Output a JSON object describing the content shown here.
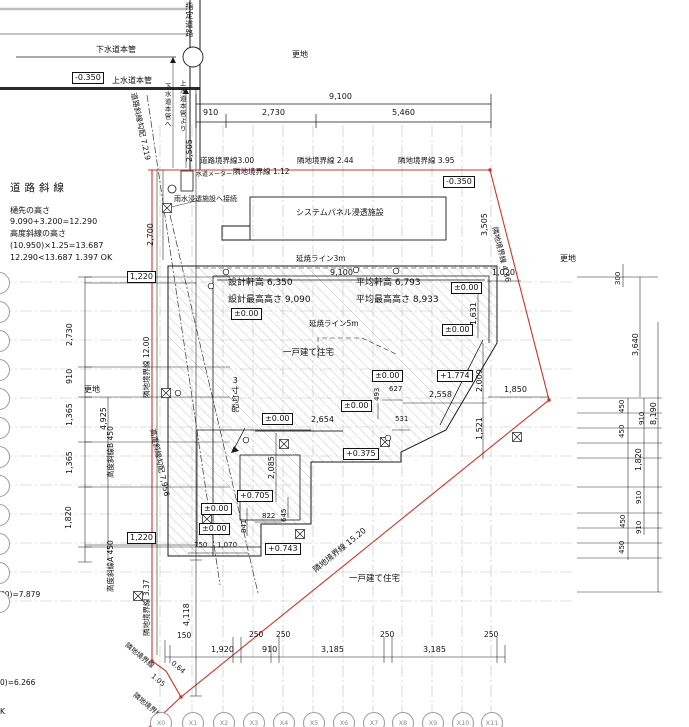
{
  "meta": {
    "bg": "#ffffff",
    "ink": "#1a1a1a",
    "red": "#c9342b",
    "grid_gray": "#c2c2c2",
    "hatch_gray": "#a0a0a0"
  },
  "notes": {
    "heading": "道路斜線",
    "line1": "樋先の高さ",
    "line2": "9.090+3.200=12.290",
    "line3": "高度斜線の高さ",
    "line4": "(10.950)×1.25=13.687",
    "line5": "12.290<13.687  1.397 OK"
  },
  "texts": [
    {
      "t": "下水道本管",
      "x": 96,
      "y": 46,
      "n": "sewer-main-label"
    },
    {
      "t": "-0.350",
      "x": 72,
      "y": 72,
      "k": "b",
      "n": "elevation-label"
    },
    {
      "t": "上水道本管",
      "x": 112,
      "y": 77,
      "n": "water-main-label"
    },
    {
      "t": "指定道路",
      "x": 184,
      "y": 2,
      "k": "j",
      "n": "designated-road-label"
    },
    {
      "t": "更地",
      "x": 292,
      "y": 51,
      "n": "area-label-vacant-lot"
    },
    {
      "t": "9,100",
      "x": 329,
      "y": 93,
      "n": "dim-label"
    },
    {
      "t": "910",
      "x": 203,
      "y": 109,
      "n": "dim-label"
    },
    {
      "t": "2,730",
      "x": 262,
      "y": 109,
      "n": "dim-label"
    },
    {
      "t": "5,460",
      "x": 392,
      "y": 109,
      "n": "dim-label"
    },
    {
      "t": "下水道本管へ",
      "x": 163,
      "y": 83,
      "k": "j",
      "s": 6.5,
      "n": "utility-label"
    },
    {
      "t": "上水道本管より",
      "x": 178,
      "y": 80,
      "k": "j",
      "s": 6.5,
      "n": "utility-label"
    },
    {
      "t": "2,505",
      "x": 186,
      "y": 162,
      "k": "v",
      "n": "dim-label"
    },
    {
      "t": "道路境界線3.00",
      "x": 200,
      "y": 157,
      "s": 7.5,
      "n": "road-boundary-label"
    },
    {
      "t": "水道メーター",
      "x": 196,
      "y": 172,
      "s": 6,
      "n": "water-meter-label"
    },
    {
      "t": "隣地境界線 1.12",
      "x": 233,
      "y": 168,
      "s": 7.5,
      "n": "boundary-label"
    },
    {
      "t": "隣地境界線 2.44",
      "x": 297,
      "y": 157,
      "s": 7.5,
      "n": "boundary-label"
    },
    {
      "t": "隣地境界線 3.95",
      "x": 398,
      "y": 157,
      "s": 7.5,
      "n": "boundary-label"
    },
    {
      "t": "-0.350",
      "x": 443,
      "y": 176,
      "k": "b",
      "n": "elevation-label"
    },
    {
      "t": "雨水浸透施設へ接続",
      "x": 174,
      "y": 196,
      "s": 7,
      "n": "rainwater-label"
    },
    {
      "t": "システムパネル浸透施設",
      "x": 296,
      "y": 209,
      "s": 8,
      "n": "infiltration-panel-label"
    },
    {
      "t": "2,700",
      "x": 147,
      "y": 246,
      "k": "v",
      "n": "dim-label"
    },
    {
      "t": "道路斜線勾配 7.219",
      "x": 137,
      "y": 92,
      "k": "r",
      "r": 78,
      "s": 7.5,
      "n": "road-slope-label"
    },
    {
      "t": "高度斜線勾配 7,956",
      "x": 156,
      "y": 428,
      "k": "r",
      "r": 78,
      "s": 7.5,
      "n": "height-slope-label"
    },
    {
      "t": "隣地境界線 4.36",
      "x": 498,
      "y": 226,
      "k": "r",
      "r": 76,
      "s": 7.5,
      "n": "boundary-label"
    },
    {
      "t": "3,505",
      "x": 481,
      "y": 236,
      "k": "v",
      "n": "dim-label"
    },
    {
      "t": "更地",
      "x": 560,
      "y": 255,
      "n": "area-label-vacant-lot"
    },
    {
      "t": "1,220",
      "x": 127,
      "y": 271,
      "k": "b",
      "n": "dim-box"
    },
    {
      "t": "2,730",
      "x": 66,
      "y": 346,
      "k": "v",
      "n": "dim-label"
    },
    {
      "t": "910",
      "x": 66,
      "y": 384,
      "k": "v",
      "n": "dim-label"
    },
    {
      "t": "更地",
      "x": 84,
      "y": 386,
      "n": "area-label-vacant-lot"
    },
    {
      "t": "1,365",
      "x": 66,
      "y": 426,
      "k": "v",
      "n": "dim-label"
    },
    {
      "t": "4,925",
      "x": 100,
      "y": 430,
      "k": "v",
      "n": "dim-label"
    },
    {
      "t": "1,365",
      "x": 66,
      "y": 474,
      "k": "v",
      "n": "dim-label"
    },
    {
      "t": "1,820",
      "x": 65,
      "y": 529,
      "k": "v",
      "n": "dim-label"
    },
    {
      "t": "高度斜線B 450",
      "x": 107,
      "y": 478,
      "k": "v",
      "s": 7.5,
      "n": "height-slope-b-label"
    },
    {
      "t": "高度斜線A 450",
      "x": 107,
      "y": 592,
      "k": "v",
      "s": 7.5,
      "n": "height-slope-a-label"
    },
    {
      "t": "隣地境界線 12.00",
      "x": 143,
      "y": 398,
      "k": "v",
      "s": 7.5,
      "n": "boundary-label"
    },
    {
      "t": "1,220",
      "x": 127,
      "y": 532,
      "k": "b",
      "n": "dim-box"
    },
    {
      "t": "延焼ライン3m",
      "x": 296,
      "y": 255,
      "s": 7.5,
      "n": "fire-spread-line-3m-label"
    },
    {
      "t": "9,100",
      "x": 330,
      "y": 269,
      "n": "dim-label"
    },
    {
      "t": "設計軒高 6,350",
      "x": 228,
      "y": 279,
      "s": 9,
      "n": "design-eave-height"
    },
    {
      "t": "平均軒高 6,793",
      "x": 356,
      "y": 279,
      "s": 9,
      "n": "average-eave-height"
    },
    {
      "t": "設計最高高さ 9,090",
      "x": 228,
      "y": 296,
      "s": 9,
      "n": "design-max-height"
    },
    {
      "t": "平均最高高さ 8,933",
      "x": 356,
      "y": 296,
      "s": 9,
      "n": "average-max-height"
    },
    {
      "t": "±0.00",
      "x": 451,
      "y": 282,
      "k": "b",
      "n": "elevation-label"
    },
    {
      "t": "1,020",
      "x": 492,
      "y": 269,
      "n": "dim-label"
    },
    {
      "t": "1,631",
      "x": 470,
      "y": 325,
      "k": "v",
      "n": "dim-label"
    },
    {
      "t": "±0.00",
      "x": 231,
      "y": 308,
      "k": "b",
      "n": "elevation-label"
    },
    {
      "t": "延焼ライン5m",
      "x": 309,
      "y": 320,
      "s": 7.5,
      "n": "fire-spread-line-5m-label"
    },
    {
      "t": "±0.00",
      "x": 442,
      "y": 324,
      "k": "b",
      "n": "elevation-label"
    },
    {
      "t": "一戸建て住宅",
      "x": 283,
      "y": 349,
      "s": 8.5,
      "n": "detached-house-label"
    },
    {
      "t": "2,009",
      "x": 476,
      "y": 392,
      "k": "v",
      "n": "dim-label"
    },
    {
      "t": "3寸勾配",
      "x": 230,
      "y": 376,
      "k": "j",
      "s": 8,
      "n": "roof-pitch-label"
    },
    {
      "t": "±0.00",
      "x": 372,
      "y": 370,
      "k": "b",
      "n": "elevation-label"
    },
    {
      "t": "+1.774",
      "x": 437,
      "y": 370,
      "k": "b",
      "n": "elevation-label"
    },
    {
      "t": "493",
      "x": 374,
      "y": 401,
      "k": "v",
      "s": 7,
      "n": "dim-label"
    },
    {
      "t": "627",
      "x": 389,
      "y": 386,
      "s": 7,
      "n": "dim-label"
    },
    {
      "t": "2,558",
      "x": 429,
      "y": 391,
      "n": "dim-label"
    },
    {
      "t": "1,850",
      "x": 504,
      "y": 386,
      "n": "dim-label"
    },
    {
      "t": "1,521",
      "x": 476,
      "y": 440,
      "k": "v",
      "n": "dim-label"
    },
    {
      "t": "±0.00",
      "x": 341,
      "y": 400,
      "k": "b",
      "n": "elevation-label"
    },
    {
      "t": "±0.00",
      "x": 262,
      "y": 413,
      "k": "b",
      "n": "elevation-label"
    },
    {
      "t": "2,654",
      "x": 311,
      "y": 416,
      "n": "dim-label"
    },
    {
      "t": "531",
      "x": 395,
      "y": 416,
      "s": 7,
      "n": "dim-label"
    },
    {
      "t": "+0.375",
      "x": 343,
      "y": 448,
      "k": "b",
      "n": "elevation-label"
    },
    {
      "t": "2,085",
      "x": 268,
      "y": 479,
      "k": "v",
      "n": "dim-label"
    },
    {
      "t": "+0.705",
      "x": 237,
      "y": 490,
      "k": "b",
      "n": "elevation-label"
    },
    {
      "t": "645",
      "x": 281,
      "y": 522,
      "k": "v",
      "s": 7,
      "n": "dim-label"
    },
    {
      "t": "841",
      "x": 241,
      "y": 533,
      "k": "v",
      "s": 7,
      "n": "dim-label"
    },
    {
      "t": "822",
      "x": 262,
      "y": 513,
      "s": 7,
      "n": "dim-label"
    },
    {
      "t": "±0.00",
      "x": 201,
      "y": 503,
      "k": "b",
      "n": "elevation-label"
    },
    {
      "t": "±0.00",
      "x": 199,
      "y": 523,
      "k": "b",
      "n": "elevation-label"
    },
    {
      "t": "750",
      "x": 194,
      "y": 542,
      "s": 7,
      "n": "dim-label"
    },
    {
      "t": "1,070",
      "x": 217,
      "y": 542,
      "s": 7,
      "n": "dim-label"
    },
    {
      "t": "+0.743",
      "x": 265,
      "y": 543,
      "k": "b",
      "n": "elevation-label"
    },
    {
      "t": "隣地境界線 15.20",
      "x": 312,
      "y": 568,
      "k": "r",
      "r": -39,
      "s": 8,
      "n": "boundary-label"
    },
    {
      "t": "一戸建て住宅",
      "x": 349,
      "y": 575,
      "s": 8.5,
      "n": "neighbor-house-label"
    },
    {
      "t": "隣地境界線 3.37",
      "x": 143,
      "y": 636,
      "k": "v",
      "s": 7.5,
      "n": "boundary-label"
    },
    {
      "t": "4,118",
      "x": 183,
      "y": 626,
      "k": "v",
      "n": "dim-label"
    },
    {
      "t": "隣地境界線",
      "x": 128,
      "y": 642,
      "k": "r",
      "r": 40,
      "s": 7,
      "n": "boundary-label"
    },
    {
      "t": "0.64",
      "x": 174,
      "y": 660,
      "k": "r",
      "r": 40,
      "s": 7,
      "n": "boundary-length-label"
    },
    {
      "t": "1.05",
      "x": 154,
      "y": 673,
      "k": "r",
      "r": 40,
      "s": 7,
      "n": "boundary-length-label"
    },
    {
      "t": "隣地境界線",
      "x": 136,
      "y": 692,
      "k": "r",
      "r": 40,
      "s": 7,
      "n": "boundary-label"
    },
    {
      "t": "80)=7.879",
      "x": 0,
      "y": 591,
      "s": 7.5,
      "n": "cut-formula-text"
    },
    {
      "t": "0)=6.266",
      "x": 0,
      "y": 679,
      "s": 7.5,
      "n": "cut-formula-text"
    },
    {
      "t": "K",
      "x": 0,
      "y": 708,
      "s": 7.5,
      "n": "cut-formula-text"
    },
    {
      "t": "300",
      "x": 615,
      "y": 285,
      "k": "v",
      "s": 7,
      "n": "dim-label"
    },
    {
      "t": "3,640",
      "x": 632,
      "y": 356,
      "k": "v",
      "n": "dim-label"
    },
    {
      "t": "450",
      "x": 619,
      "y": 413,
      "k": "v",
      "s": 7,
      "n": "dim-label"
    },
    {
      "t": "910",
      "x": 639,
      "y": 425,
      "k": "v",
      "s": 7,
      "n": "dim-label"
    },
    {
      "t": "8,190",
      "x": 650,
      "y": 425,
      "k": "v",
      "n": "dim-label"
    },
    {
      "t": "450",
      "x": 619,
      "y": 438,
      "k": "v",
      "s": 7,
      "n": "dim-label"
    },
    {
      "t": "1,820",
      "x": 635,
      "y": 471,
      "k": "v",
      "n": "dim-label"
    },
    {
      "t": "910",
      "x": 636,
      "y": 504,
      "k": "v",
      "s": 7,
      "n": "dim-label"
    },
    {
      "t": "450",
      "x": 620,
      "y": 528,
      "k": "v",
      "s": 7,
      "n": "dim-label"
    },
    {
      "t": "910",
      "x": 636,
      "y": 534,
      "k": "v",
      "s": 7,
      "n": "dim-label"
    },
    {
      "t": "450",
      "x": 619,
      "y": 554,
      "k": "v",
      "s": 7,
      "n": "dim-label"
    },
    {
      "t": "150",
      "x": 177,
      "y": 632,
      "s": 7.5,
      "n": "dim-label"
    },
    {
      "t": "1,920",
      "x": 211,
      "y": 646,
      "n": "dim-label"
    },
    {
      "t": "250",
      "x": 249,
      "y": 631,
      "s": 7.5,
      "n": "dim-label"
    },
    {
      "t": "910",
      "x": 262,
      "y": 646,
      "n": "dim-label"
    },
    {
      "t": "250",
      "x": 276,
      "y": 631,
      "s": 7.5,
      "n": "dim-label"
    },
    {
      "t": "3,185",
      "x": 321,
      "y": 646,
      "n": "dim-label"
    },
    {
      "t": "250",
      "x": 380,
      "y": 631,
      "s": 7.5,
      "n": "dim-label"
    },
    {
      "t": "3,185",
      "x": 423,
      "y": 646,
      "n": "dim-label"
    },
    {
      "t": "250",
      "x": 484,
      "y": 631,
      "s": 7.5,
      "n": "dim-label"
    }
  ],
  "grid": {
    "x_bubbles": [
      {
        "label": "X0",
        "cx": 160
      },
      {
        "label": "X1",
        "cx": 192
      },
      {
        "label": "X2",
        "cx": 223
      },
      {
        "label": "X3",
        "cx": 253
      },
      {
        "label": "X4",
        "cx": 283
      },
      {
        "label": "X5",
        "cx": 313
      },
      {
        "label": "X6",
        "cx": 343
      },
      {
        "label": "X7",
        "cx": 373
      },
      {
        "label": "X8",
        "cx": 402
      },
      {
        "label": "X9",
        "cx": 432
      },
      {
        "label": "X10",
        "cx": 462
      },
      {
        "label": "X11",
        "cx": 491
      }
    ],
    "y_bubble_ys": [
      282,
      311,
      340,
      369,
      398,
      427,
      456,
      485,
      514,
      543,
      572,
      601
    ]
  }
}
